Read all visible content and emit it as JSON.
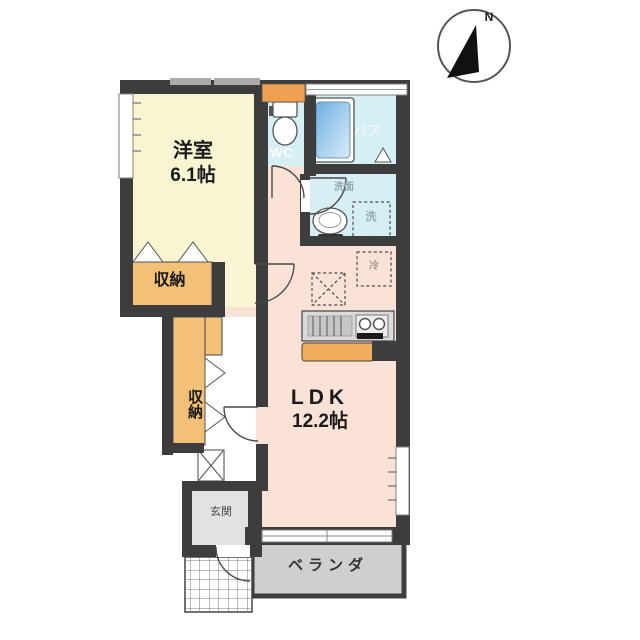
{
  "colors": {
    "wall": "#3d3d3d",
    "room_yellow": "#f9f5d2",
    "room_salmon": "#fbe2d7",
    "room_cyan": "#d6eff4",
    "storage_orange": "#f3c077",
    "window_orange": "#efa050",
    "counter_gray": "#dadada",
    "cabinet_orange": "#f0ae5e",
    "genkan_gray": "#e2e2e2",
    "veranda_gray": "#cfcfcf",
    "tub_blue_dark": "#6fb0e2",
    "tub_blue_light": "#d8edf8",
    "text_dark": "#1a1a1a",
    "text_light": "#ffffff",
    "text_muted": "#95a9ad",
    "compass_black": "#111111"
  },
  "compass": {
    "north_label": "N"
  },
  "rooms": {
    "western_room": {
      "name": "洋室",
      "size": "6.1帖"
    },
    "ldk": {
      "name": "LDK",
      "size": "12.2帖"
    },
    "wc": {
      "label": "WC"
    },
    "bath": {
      "label": "バス"
    },
    "washroom": {
      "label": "洗面"
    },
    "washer_space": {
      "label": "洗"
    },
    "fridge_space": {
      "label": "冷"
    },
    "storage_upper": {
      "label": "収納"
    },
    "storage_lower": {
      "label": "収納"
    },
    "entrance": {
      "label": "玄関"
    },
    "veranda": {
      "label": "ベランダ"
    }
  }
}
